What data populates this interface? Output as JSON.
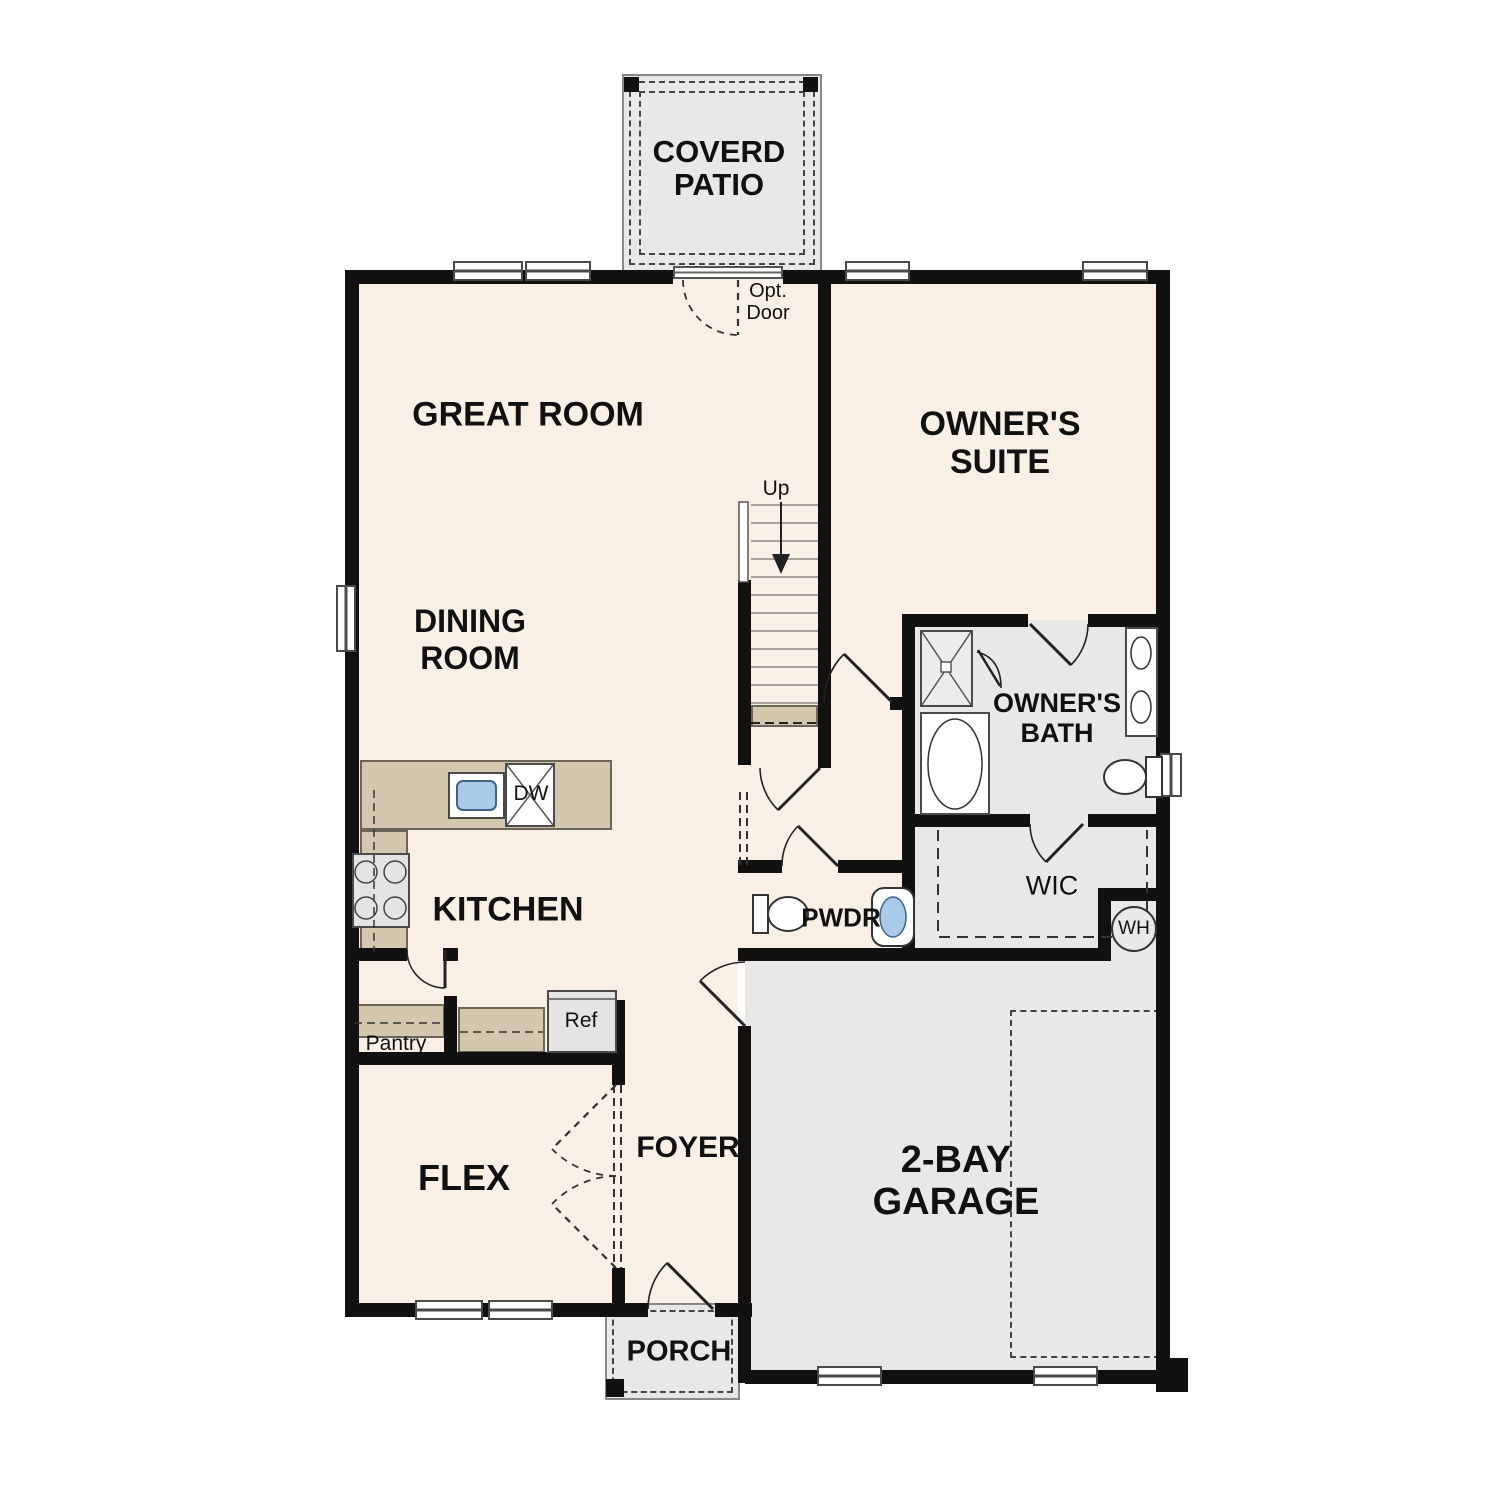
{
  "floor_plan": {
    "rooms": {
      "covered_patio": {
        "line1": "COVERD",
        "line2": "PATIO"
      },
      "great_room": "GREAT ROOM",
      "owners_suite": {
        "line1": "OWNER'S",
        "line2": "SUITE"
      },
      "dining_room": {
        "line1": "DINING",
        "line2": "ROOM"
      },
      "kitchen": "KITCHEN",
      "owners_bath": {
        "line1": "OWNER'S",
        "line2": "BATH"
      },
      "wic": "WIC",
      "pwdr": "PWDR",
      "pantry": "Pantry",
      "flex": "FLEX",
      "foyer": "FOYER",
      "garage": {
        "line1": "2-BAY",
        "line2": "GARAGE"
      },
      "porch": "PORCH"
    },
    "labels": {
      "up": "Up",
      "opt_door_line1": "Opt.",
      "opt_door_line2": "Door",
      "dishwasher": "DW",
      "refrigerator": "Ref",
      "water_heater": "WH"
    },
    "colors": {
      "floor": "#f8f0e5",
      "hard_surface": "#e8e8e6",
      "counter": "#d3c8ad",
      "wall": "#111111",
      "sink_water": "#a9cae9"
    }
  }
}
